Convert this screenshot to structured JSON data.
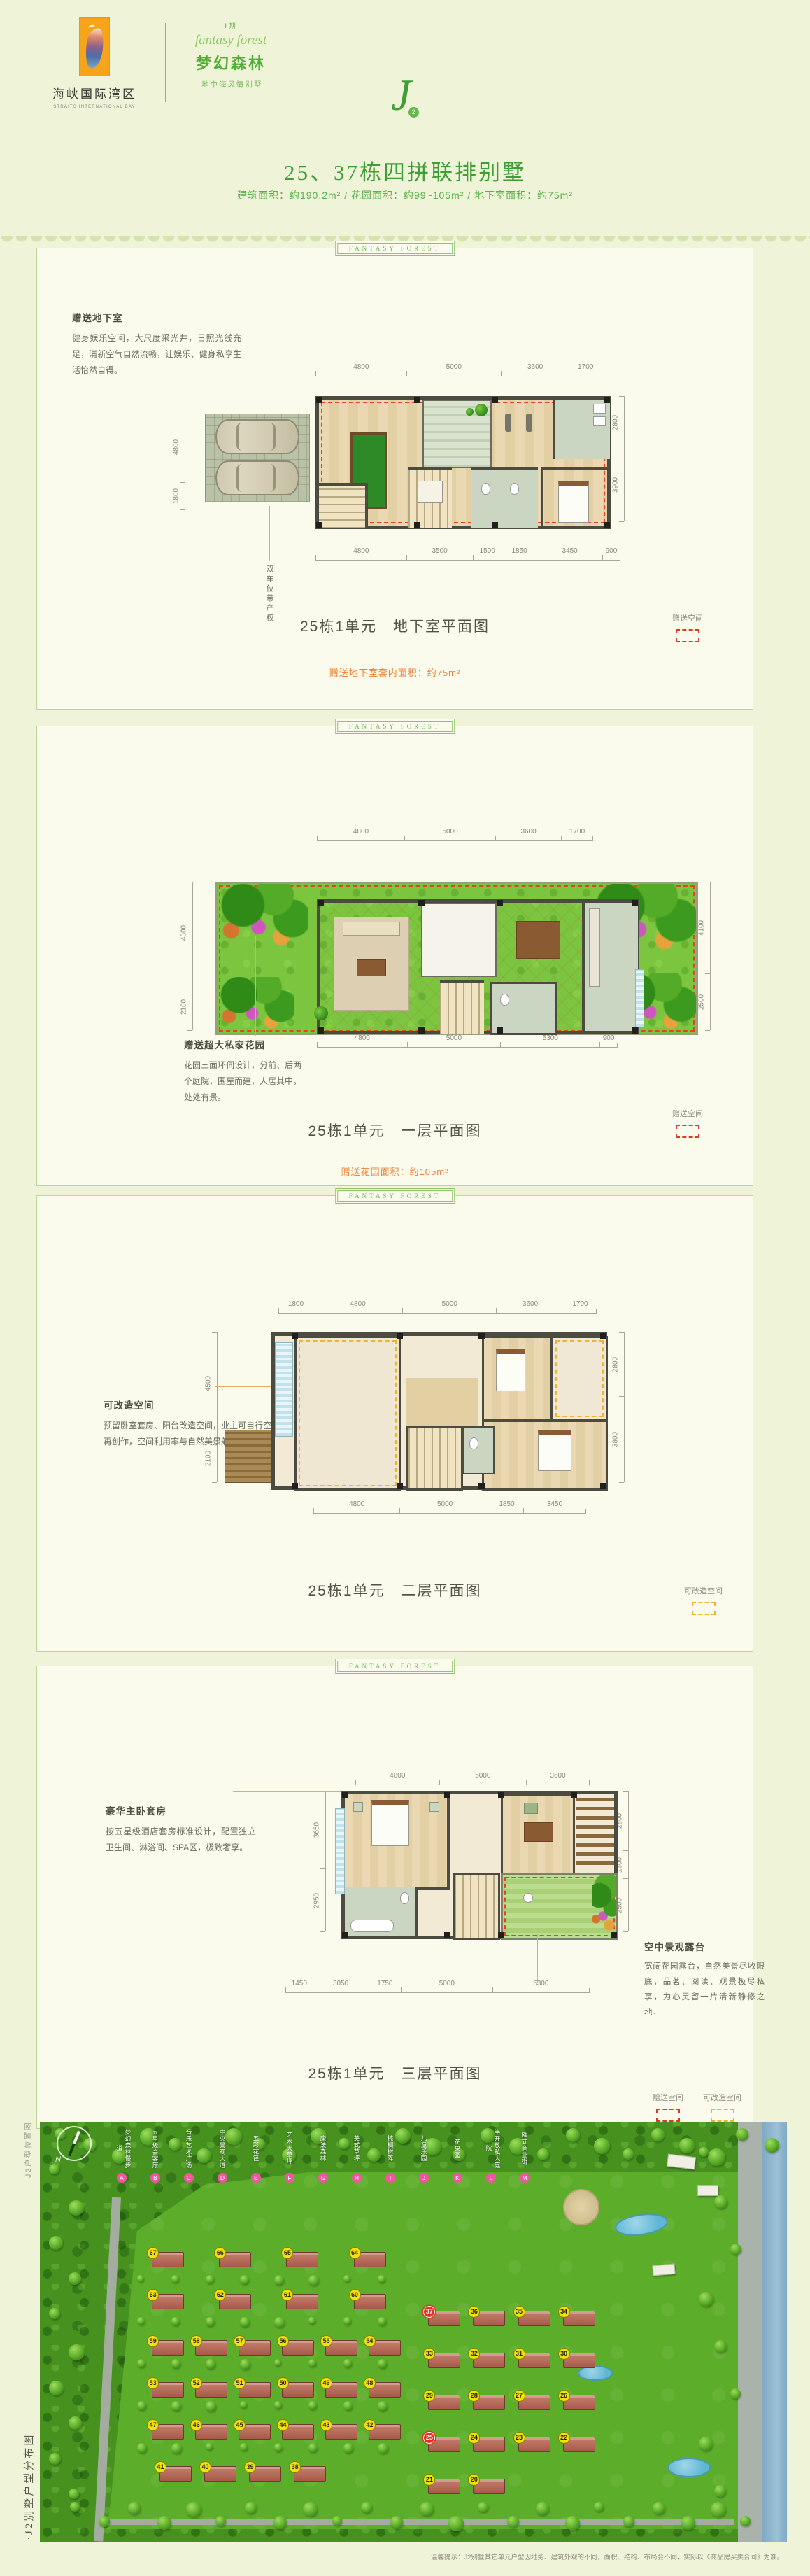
{
  "header": {
    "logo_cn": "海峡国际湾区",
    "logo_en": "STRAITS INTERNATIONAL BAY",
    "phase": "Ⅱ期",
    "brand_script": "fantasy forest",
    "brand_name": "梦幻森林",
    "brand_tagline": "地中海风情别墅",
    "monogram": "J",
    "monogram_badge": "2"
  },
  "title": {
    "main": "25、37栋四拼联排别墅",
    "sub": "建筑面积：约190.2m² / 花园面积：约99~105m² / 地下室面积：约75m²"
  },
  "panel_tab": "Fantasy Forest",
  "legend_labels": {
    "gift": "赠送空间",
    "convertible": "可改造空间"
  },
  "panels": [
    {
      "id": "basement",
      "note_title": "赠送地下室",
      "note_body": "健身娱乐空间，大尺度采光井，日照光线充足，清新空气自然流畅，让娱乐、健身私享生活怡然自得。",
      "garage_label": "双车位带产权",
      "caption": "25栋1单元　地下室平面图",
      "highlight": "赠送地下室套内面积：约75m²",
      "dims": {
        "top": [
          4800,
          5000,
          3600,
          1700
        ],
        "bottom": [
          4800,
          3500,
          1500,
          1850,
          3450,
          900
        ],
        "left": [
          4800,
          1800
        ],
        "right": [
          2800,
          3900
        ]
      },
      "legends": [
        "gift"
      ]
    },
    {
      "id": "floor1",
      "note_title": "赠送超大私家花园",
      "note_body": "花园三面环伺设计，分前、后两个庭院，围屋而建，人居其中，处处有景。",
      "caption": "25栋1单元　一层平面图",
      "highlight": "赠送花园面积：约105m²",
      "dims": {
        "top": [
          4800,
          5000,
          3600,
          1700
        ],
        "bottom": [
          4800,
          5000,
          5300,
          900
        ],
        "left": [
          4500,
          2100
        ],
        "right": [
          4100,
          2500
        ]
      },
      "legends": [
        "gift"
      ]
    },
    {
      "id": "floor2",
      "note_title": "可改造空间",
      "note_body": "预留卧室套房、阳台改造空间，业主可自行空间再创作，空间利用率与自然美景兼收并蓄。",
      "caption": "25栋1单元　二层平面图",
      "dims": {
        "top": [
          1800,
          4800,
          5000,
          3600,
          1700
        ],
        "bottom": [
          4800,
          5000,
          1850,
          3450
        ],
        "left": [
          4500,
          2100
        ],
        "right": [
          2800,
          3800
        ]
      },
      "legends": [
        "convertible"
      ]
    },
    {
      "id": "floor3",
      "note_title": "豪华主卧套房",
      "note_body": "按五星级酒店套房标准设计，配置独立卫生间、淋浴间、SPA区，极致奢享。",
      "note2_title": "空中景观露台",
      "note2_body": "宽阔花园露台，自然美景尽收眼底，品茗、阅读、观景极尽私享，为心灵留一片清新静修之地。",
      "caption": "25栋1单元　三层平面图",
      "dims": {
        "top": [
          4800,
          5000,
          3600
        ],
        "bottom": [
          1450,
          3050,
          1750,
          5000,
          5300
        ],
        "left": [
          3650,
          2950
        ],
        "right": [
          2800,
          1300,
          2500
        ]
      },
      "legends": [
        "gift",
        "convertible"
      ]
    }
  ],
  "map": {
    "side_label_top": "J2户型位置图",
    "side_label_bottom": "·J2别墅户型分布图",
    "compass": "N",
    "legend": [
      {
        "letter": "A",
        "label": "梦幻森林慢步道"
      },
      {
        "letter": "B",
        "label": "五星级会客厅"
      },
      {
        "letter": "C",
        "label": "音乐艺术广场"
      },
      {
        "letter": "D",
        "label": "中央景观大道"
      },
      {
        "letter": "E",
        "label": "五彩花径"
      },
      {
        "letter": "F",
        "label": "艺术大草坪"
      },
      {
        "letter": "G",
        "label": "魔法森林"
      },
      {
        "letter": "H",
        "label": "美式草坪"
      },
      {
        "letter": "I",
        "label": "棕榈树阵"
      },
      {
        "letter": "J",
        "label": "儿童乐园"
      },
      {
        "letter": "K",
        "label": "花果园"
      },
      {
        "letter": "L",
        "label": "半开放私人庭院"
      },
      {
        "letter": "M",
        "label": "欧式商业街"
      }
    ],
    "buildings": [
      {
        "n": "67",
        "x": 15,
        "y": 31
      },
      {
        "n": "66",
        "x": 24,
        "y": 31
      },
      {
        "n": "65",
        "x": 33,
        "y": 31
      },
      {
        "n": "64",
        "x": 42,
        "y": 31
      },
      {
        "n": "63",
        "x": 15,
        "y": 41
      },
      {
        "n": "62",
        "x": 24,
        "y": 41
      },
      {
        "n": "61",
        "x": 33,
        "y": 41
      },
      {
        "n": "60",
        "x": 42,
        "y": 41
      },
      {
        "n": "59",
        "x": 15,
        "y": 52
      },
      {
        "n": "58",
        "x": 20.8,
        "y": 52
      },
      {
        "n": "57",
        "x": 26.6,
        "y": 52
      },
      {
        "n": "56",
        "x": 32.4,
        "y": 52
      },
      {
        "n": "55",
        "x": 38.2,
        "y": 52
      },
      {
        "n": "54",
        "x": 44,
        "y": 52
      },
      {
        "n": "53",
        "x": 15,
        "y": 62
      },
      {
        "n": "52",
        "x": 20.8,
        "y": 62
      },
      {
        "n": "51",
        "x": 26.6,
        "y": 62
      },
      {
        "n": "50",
        "x": 32.4,
        "y": 62
      },
      {
        "n": "49",
        "x": 38.2,
        "y": 62
      },
      {
        "n": "48",
        "x": 44,
        "y": 62
      },
      {
        "n": "47",
        "x": 15,
        "y": 72
      },
      {
        "n": "46",
        "x": 20.8,
        "y": 72
      },
      {
        "n": "45",
        "x": 26.6,
        "y": 72
      },
      {
        "n": "44",
        "x": 32.4,
        "y": 72
      },
      {
        "n": "43",
        "x": 38.2,
        "y": 72
      },
      {
        "n": "42",
        "x": 44,
        "y": 72
      },
      {
        "n": "41",
        "x": 16,
        "y": 82
      },
      {
        "n": "40",
        "x": 22,
        "y": 82
      },
      {
        "n": "39",
        "x": 28,
        "y": 82
      },
      {
        "n": "38",
        "x": 34,
        "y": 82
      },
      {
        "n": "37",
        "x": 52,
        "y": 45,
        "hl": true
      },
      {
        "n": "36",
        "x": 58,
        "y": 45
      },
      {
        "n": "35",
        "x": 64,
        "y": 45
      },
      {
        "n": "34",
        "x": 70,
        "y": 45
      },
      {
        "n": "33",
        "x": 52,
        "y": 55
      },
      {
        "n": "32",
        "x": 58,
        "y": 55
      },
      {
        "n": "31",
        "x": 64,
        "y": 55
      },
      {
        "n": "30",
        "x": 70,
        "y": 55
      },
      {
        "n": "29",
        "x": 52,
        "y": 65
      },
      {
        "n": "28",
        "x": 58,
        "y": 65
      },
      {
        "n": "27",
        "x": 64,
        "y": 65
      },
      {
        "n": "26",
        "x": 70,
        "y": 65
      },
      {
        "n": "25",
        "x": 52,
        "y": 75,
        "hl": true
      },
      {
        "n": "24",
        "x": 58,
        "y": 75
      },
      {
        "n": "23",
        "x": 64,
        "y": 75
      },
      {
        "n": "22",
        "x": 70,
        "y": 75
      },
      {
        "n": "21",
        "x": 52,
        "y": 85
      },
      {
        "n": "20",
        "x": 58,
        "y": 85
      }
    ]
  },
  "footer": "温馨提示：J2别墅其它单元户型因地势、建筑外观的不同，面积、结构、布局会不同，实际以《商品房买卖合同》为准。"
}
